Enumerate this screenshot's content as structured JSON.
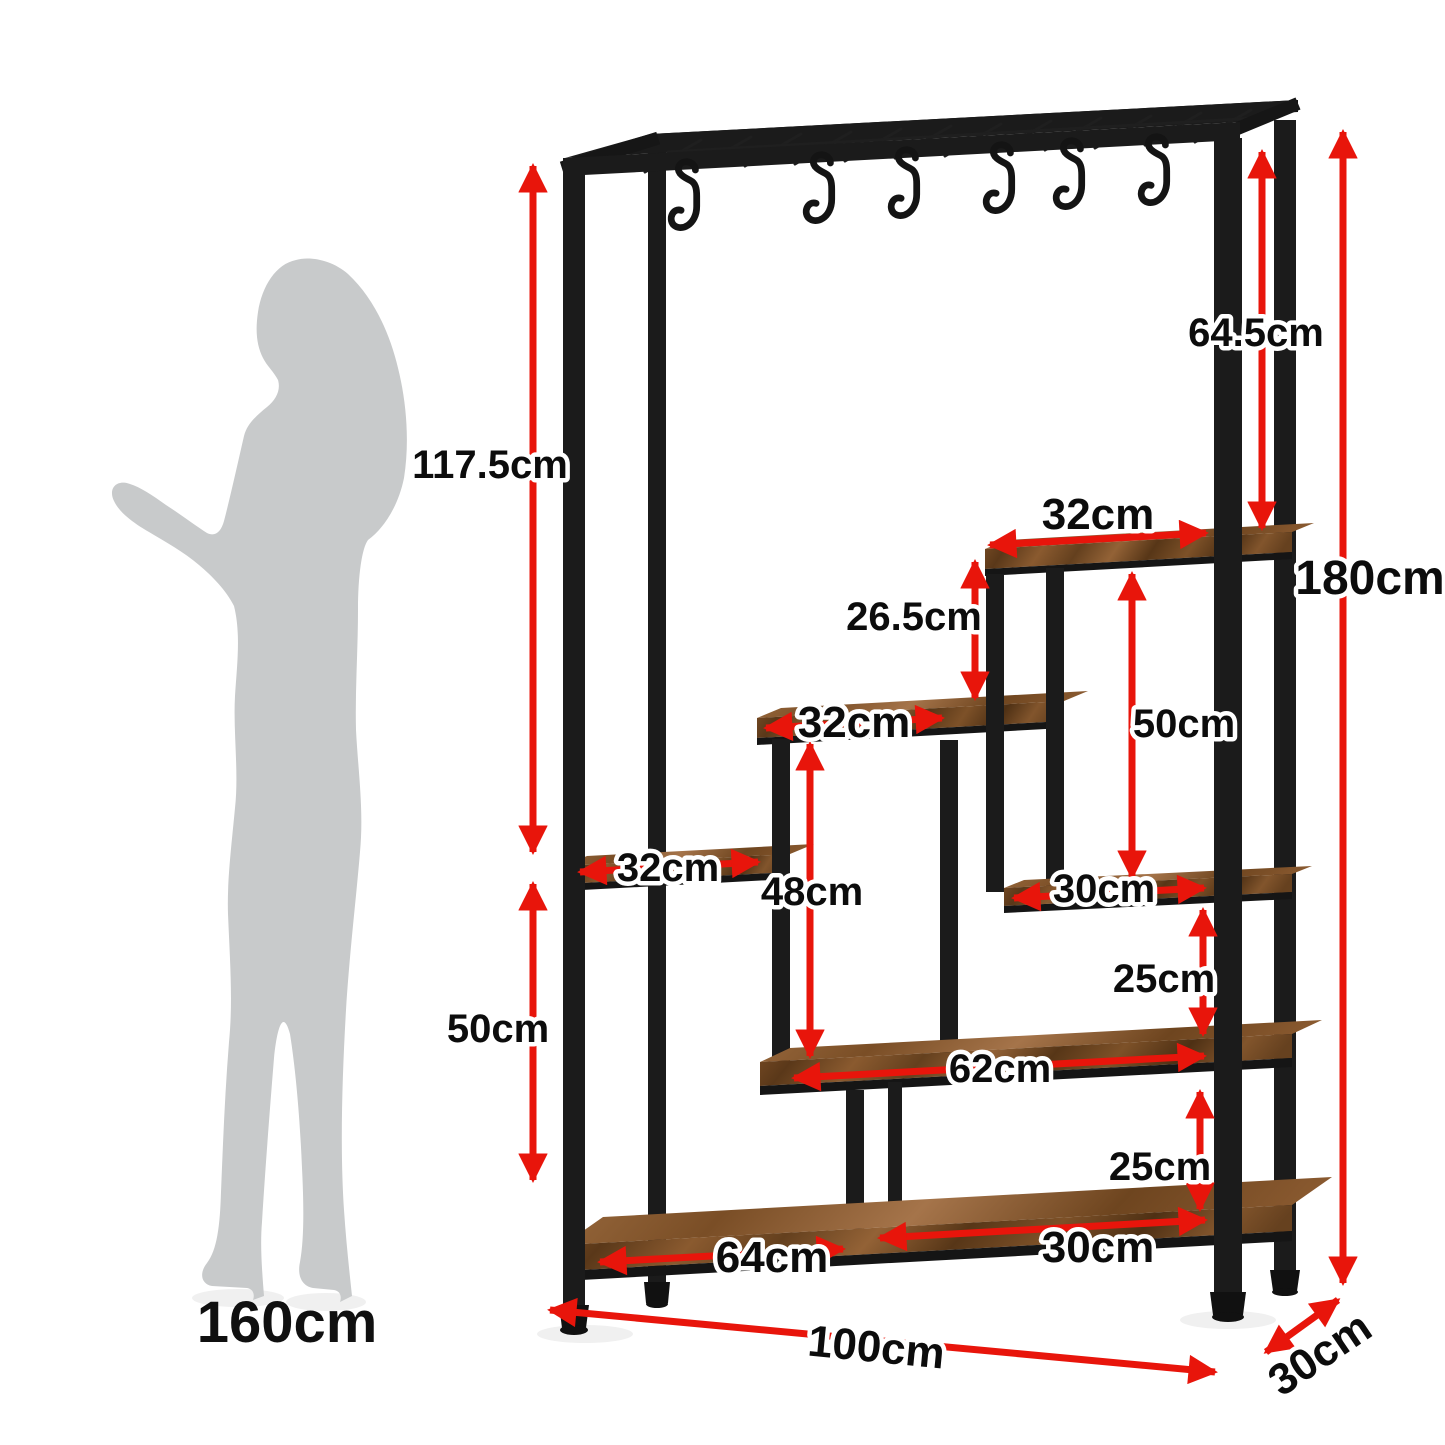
{
  "diagram_type": "furniture-dimension-diagram",
  "product": "industrial ladder shelf / coat rack with hooks and 6 rustic wood shelves",
  "figure": {
    "height": "160cm"
  },
  "dims": {
    "upper_left_height": "117.5cm",
    "lower_left_height": "50cm",
    "hanging_clearance": "64.5cm",
    "total_height": "180cm",
    "top_shelf_width": "32cm",
    "top_gap": "26.5cm",
    "right_gap": "50cm",
    "mid_shelf_width": "32cm",
    "left_shelf_width": "32cm",
    "mid_gap": "48cm",
    "right_shelf_width": "30cm",
    "upper_right_gap": "25cm",
    "long_shelf_width": "62cm",
    "lower_right_gap": "25cm",
    "bottom_left_width": "64cm",
    "bottom_right_width": "30cm",
    "total_width": "100cm",
    "total_depth": "30cm"
  },
  "counts": {
    "hooks": 6,
    "shelves": 6
  },
  "colors": {
    "dimension_red": "#e8150b",
    "frame_black": "#1b1b1b",
    "wood_brown": "#7a4f28",
    "silhouette_gray": "#c8cacb",
    "label_black": "#0c0c0c",
    "background": "#ffffff"
  }
}
